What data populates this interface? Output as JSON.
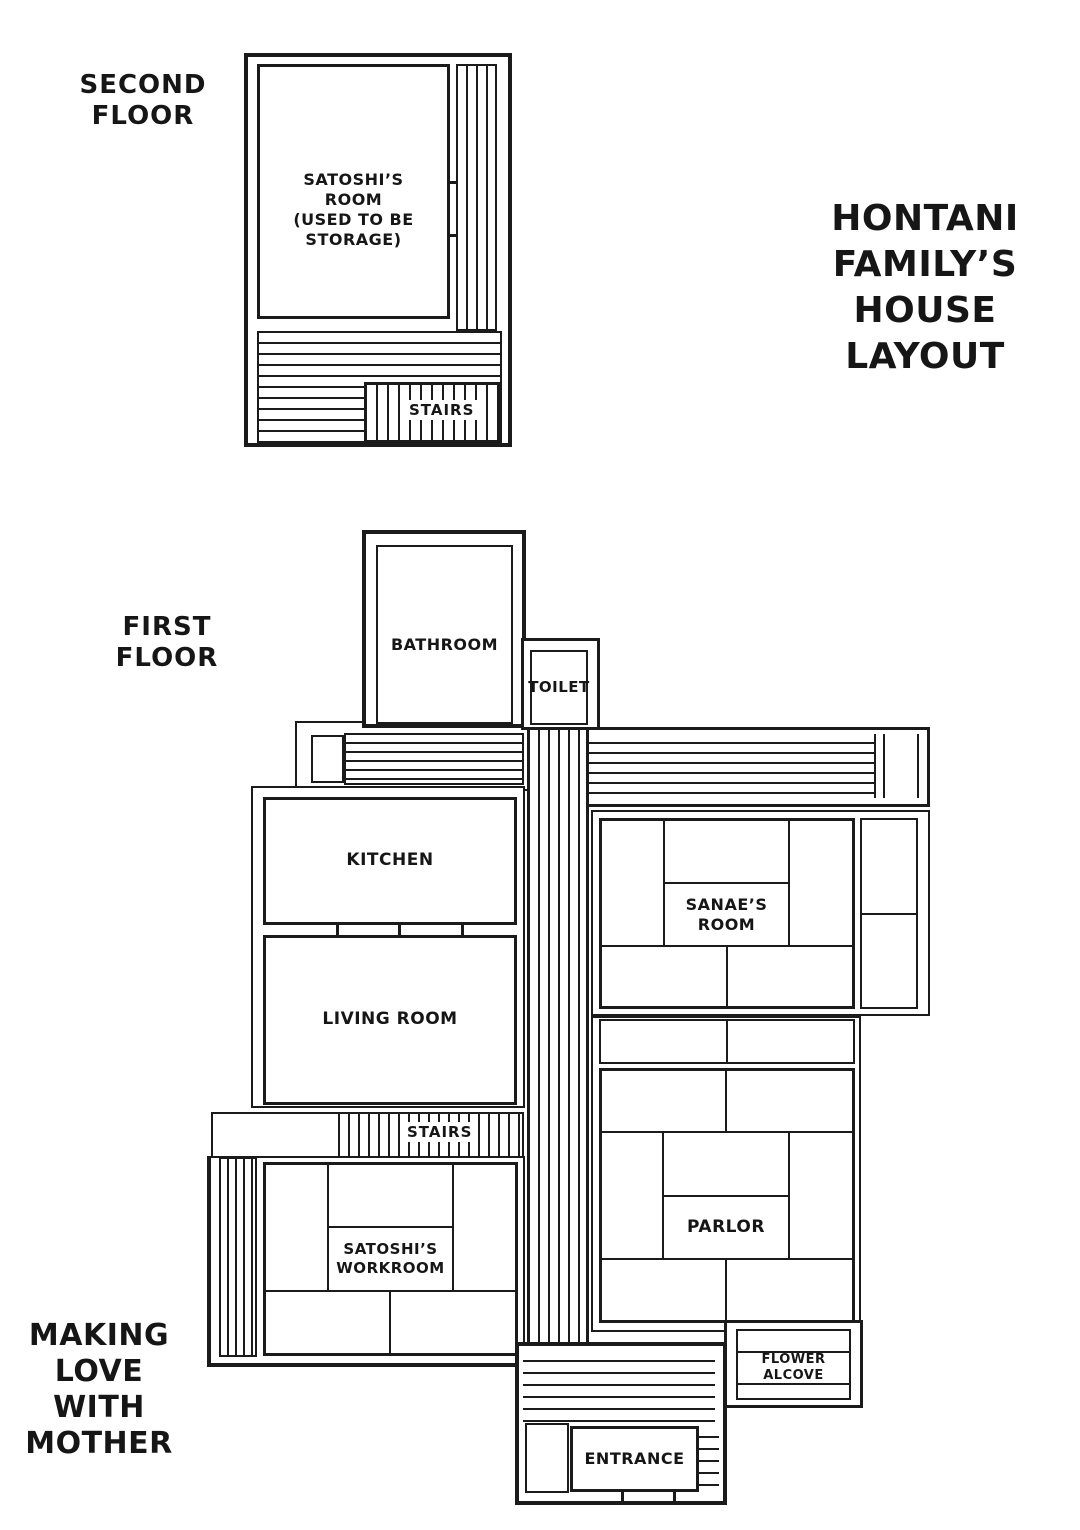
{
  "header": {
    "house_title": "HONTANI\nFAMILY’S\nHOUSE\nLAYOUT"
  },
  "footer": {
    "series_title": "MAKING\nLOVE\nWITH\nMOTHER"
  },
  "floors": {
    "second": {
      "title": "SECOND\nFLOOR",
      "rooms": {
        "satoshis_room": "SATOSHI’S\nROOM\n(USED TO BE\nSTORAGE)",
        "stairs": "STAIRS"
      }
    },
    "first": {
      "title": "FIRST\nFLOOR",
      "rooms": {
        "bathroom": "BATHROOM",
        "toilet": "TOILET",
        "kitchen": "KITCHEN",
        "living_room": "LIVING ROOM",
        "sanaes_room": "SANAE’S\nROOM",
        "stairs": "STAIRS",
        "satoshis_workroom": "SATOSHI’S\nWORKROOM",
        "parlor": "PARLOR",
        "flower_alcove": "FLOWER\nALCOVE",
        "entrance": "ENTRANCE"
      }
    }
  },
  "colors": {
    "line": "#1b1b1b",
    "background": "#ffffff"
  }
}
